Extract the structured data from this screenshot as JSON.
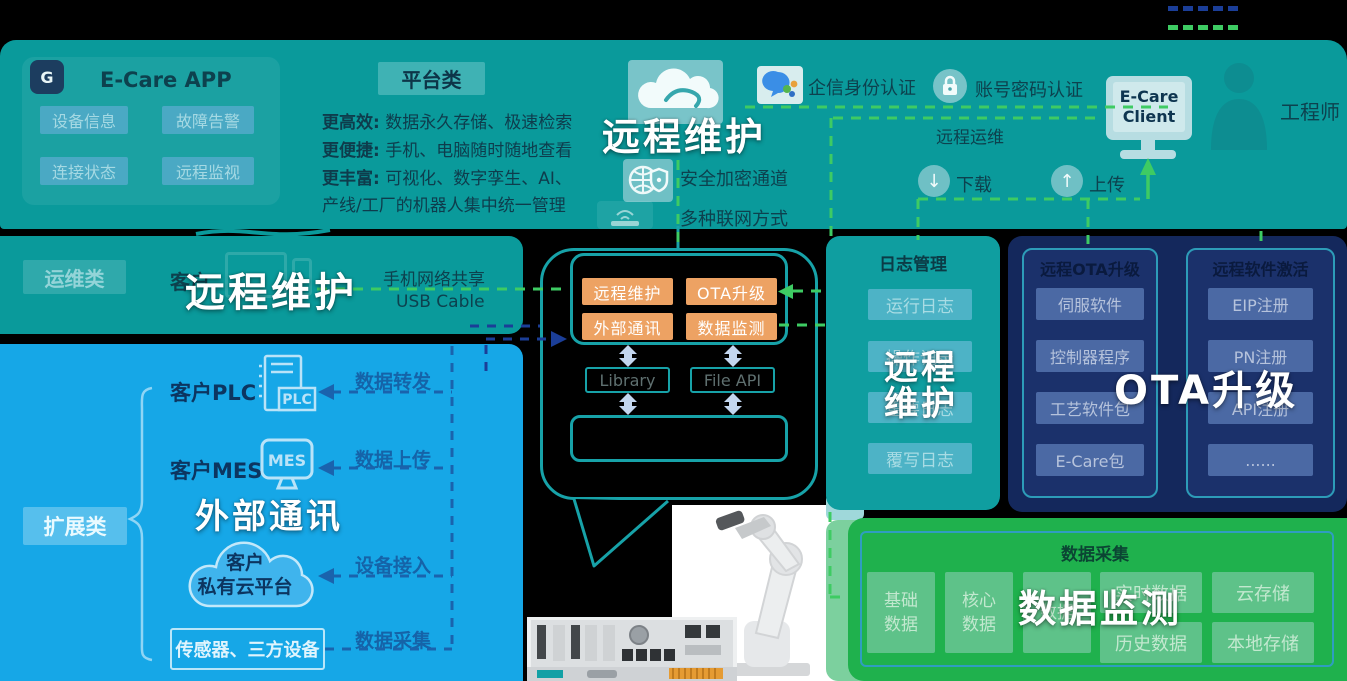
{
  "top_band": {
    "app_card": {
      "title": "E-Care APP",
      "buttons": [
        "设备信息",
        "故障告警",
        "连接状态",
        "远程监视"
      ]
    },
    "platform_badge": "平台类",
    "features": [
      {
        "head": "更高效:",
        "body": " 数据永久存储、极速检索"
      },
      {
        "head": "更便捷:",
        "body": " 手机、电脑随时随地查看"
      },
      {
        "head": "更丰富:",
        "body": " 可视化、数字孪生、AI、"
      },
      {
        "head": "",
        "body": "产线/工厂的机器人集中统一管理"
      }
    ],
    "cloud_overlay": "远程维护",
    "auth_wechat": "企信身份认证",
    "auth_password": "账号密码认证",
    "secure_channel": "安全加密通道",
    "network_modes": "多种联网方式",
    "remote_ops": "远程运维",
    "download": "下载",
    "upload": "上传",
    "client_line1": "E-Care",
    "client_line2": "Client",
    "engineer": "工程师"
  },
  "ops_band": {
    "badge": "运维类",
    "customer": "客户",
    "overlay": "远程维护",
    "net_share": "手机网络共享",
    "usb": "USB Cable"
  },
  "extend_panel": {
    "badge": "扩展类",
    "overlay": "外部通讯",
    "plc": "客户PLC",
    "mes": "客户MES",
    "plc_icon": "PLC",
    "mes_icon": "MES",
    "cloud1": "客户",
    "cloud2": "私有云平台",
    "sensors": "传感器、三方设备",
    "links": [
      "数据转发",
      "数据上传",
      "设备接入",
      "数据采集"
    ]
  },
  "bubble": {
    "modules": [
      "远程维护",
      "OTA升级",
      "外部通讯",
      "数据监测"
    ],
    "library": "Library",
    "file_api": "File API"
  },
  "log_panel": {
    "title": "日志管理",
    "buttons": [
      "运行日志",
      "操作记录",
      "重要日志",
      "覆写日志"
    ],
    "overlay1": "远程",
    "overlay2": "维护"
  },
  "ota_panel": {
    "overlay": "OTA升级",
    "left_title": "远程OTA升级",
    "left_buttons": [
      "伺服软件",
      "控制器程序",
      "工艺软件包",
      "E-Care包"
    ],
    "right_title": "远程软件激活",
    "right_buttons": [
      "EIP注册",
      "PN注册",
      "API注册",
      "......"
    ]
  },
  "data_panel": {
    "title": "数据采集",
    "overlay": "数据监测",
    "squares": [
      {
        "a": "基础",
        "b": "数据"
      },
      {
        "a": "核心",
        "b": "数据"
      },
      {
        "a": "",
        "b": "数据"
      }
    ],
    "wide": [
      "实时数据",
      "云存储",
      "历史数据",
      "本地存储"
    ]
  },
  "colors": {
    "teal_band": "#0a9a9b",
    "log_panel": "#0f9ea0",
    "blue_panel": "#16a7e7",
    "navy_panel": "#14285c",
    "green_panel": "#1fb14d",
    "orange_chip": "#eda263",
    "teal_chip": "#4aa9c4",
    "dash_green": "#3ecb63",
    "dash_navy": "#1b3e97",
    "dash_blue": "#1a63ad",
    "overlay_text": "#ffffff"
  }
}
